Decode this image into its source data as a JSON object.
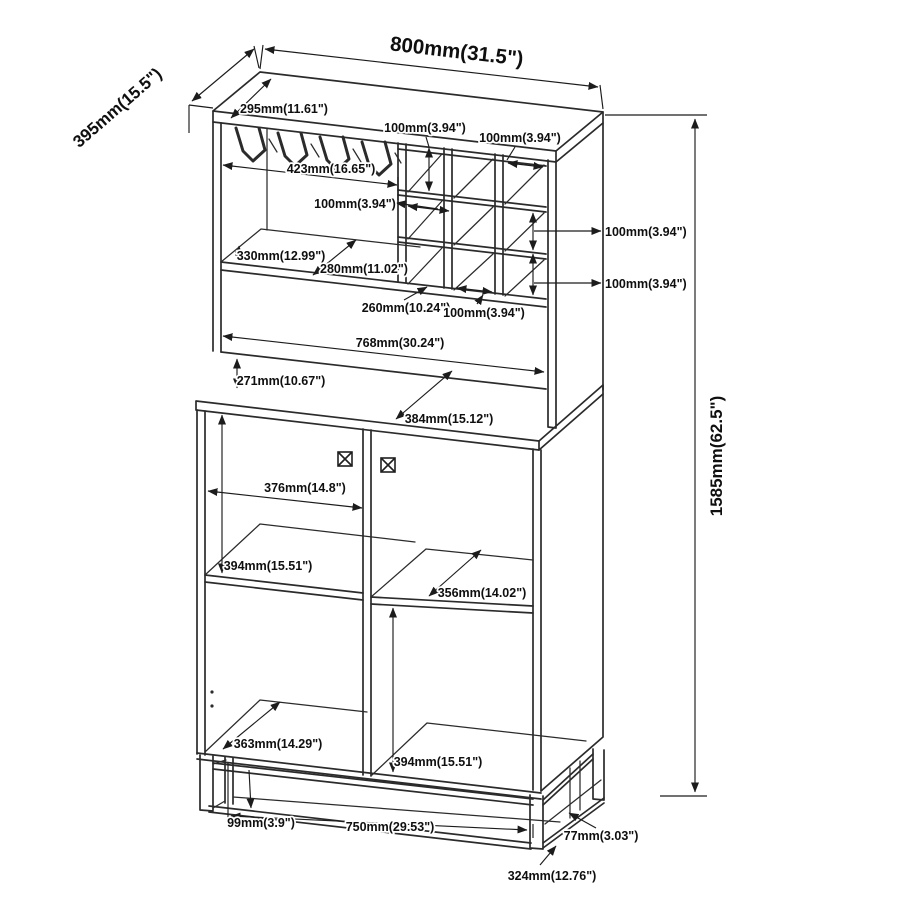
{
  "colors": {
    "line": "#2b2b2b",
    "dimension": "#1c1c1c",
    "background": "#ffffff"
  },
  "dimensions": {
    "overall_width": "800mm(31.5\")",
    "overall_depth": "395mm(15.5\")",
    "overall_height": "1585mm(62.5\")",
    "top_inner_depth": "295mm(11.61\")",
    "cubby_col_width_a": "100mm(3.94\")",
    "cubby_col_width_b": "100mm(3.94\")",
    "glass_rack_width": "423mm(16.65\")",
    "cubby_cell_width": "100mm(3.94\")",
    "hutch_upper_height": "330mm(12.99\")",
    "hutch_shelf_depth": "280mm(11.02\")",
    "cubby_row_height_a": "100mm(3.94\")",
    "cubby_row_height_b": "100mm(3.94\")",
    "cubby_depth": "260mm(10.24\")",
    "cubby_bottom_width": "100mm(3.94\")",
    "hutch_interior_width": "768mm(30.24\")",
    "hutch_open_height": "271mm(10.67\")",
    "counter_depth": "384mm(15.12\")",
    "door_opening_width": "376mm(14.8\")",
    "left_shelf_spacing": "394mm(15.51\")",
    "right_shelf_depth": "356mm(14.02\")",
    "bottom_shelf_depth": "363mm(14.29\")",
    "right_shelf_spacing": "394mm(15.51\")",
    "base_height": "99mm(3.9\")",
    "base_width": "750mm(29.53\")",
    "base_rail": "77mm(3.03\")",
    "base_depth": "324mm(12.76\")"
  }
}
